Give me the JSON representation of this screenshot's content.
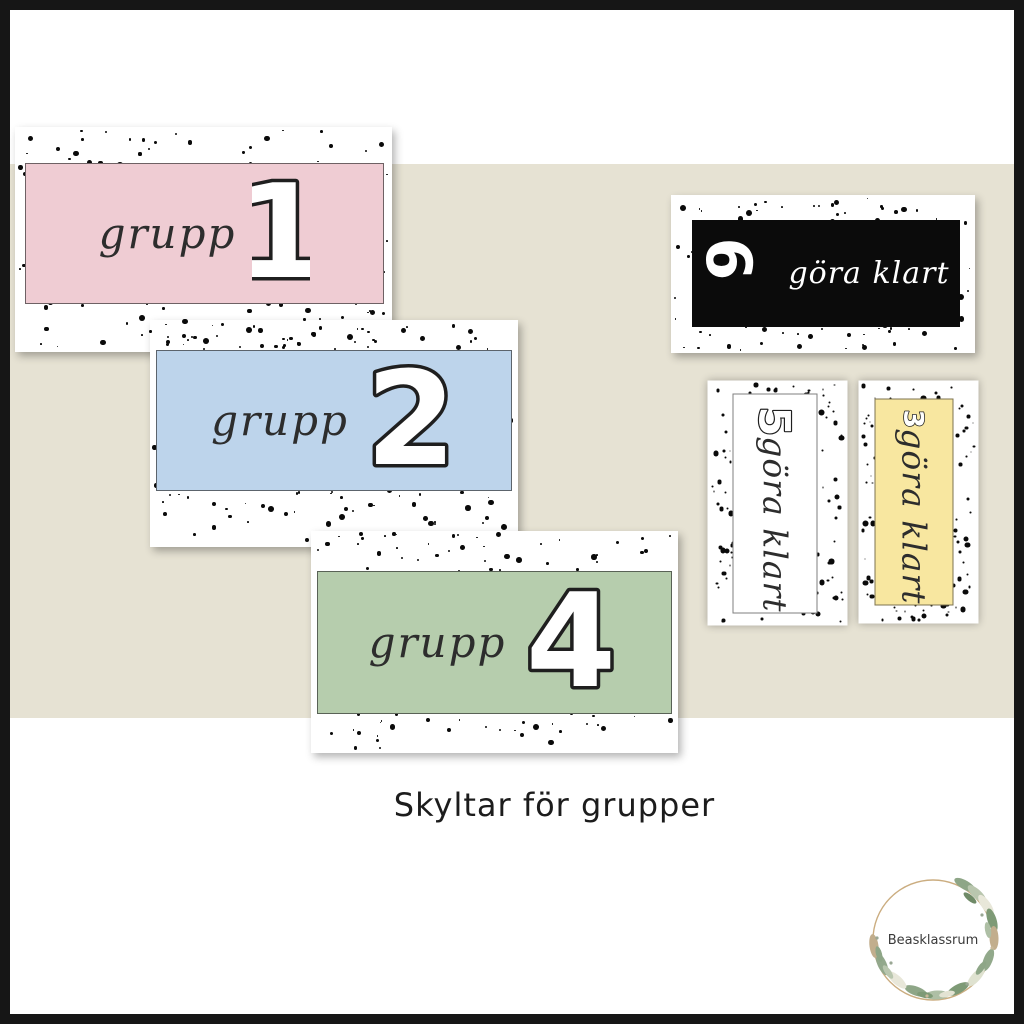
{
  "page": {
    "caption": "Skyltar för grupper",
    "background_color": "#ffffff",
    "frame_color": "#161616",
    "band_color": "#e6e2d3"
  },
  "cards": {
    "grupp1": {
      "label": "grupp",
      "number": "1",
      "color": "#efccd3"
    },
    "grupp2": {
      "label": "grupp",
      "number": "2",
      "color": "#bdd4eb"
    },
    "grupp4": {
      "label": "grupp",
      "number": "4",
      "color": "#b6cdad"
    },
    "gora6": {
      "label": "göra klart",
      "number": "6",
      "color": "#0b0b0b",
      "text_color": "#ffffff"
    },
    "gora5": {
      "label": "göra klart",
      "number": "5",
      "color": "#ffffff"
    },
    "gora3": {
      "label": "göra klart",
      "number": "3",
      "color": "#f8e7a0"
    }
  },
  "logo": {
    "name": "Beasklassrum"
  }
}
